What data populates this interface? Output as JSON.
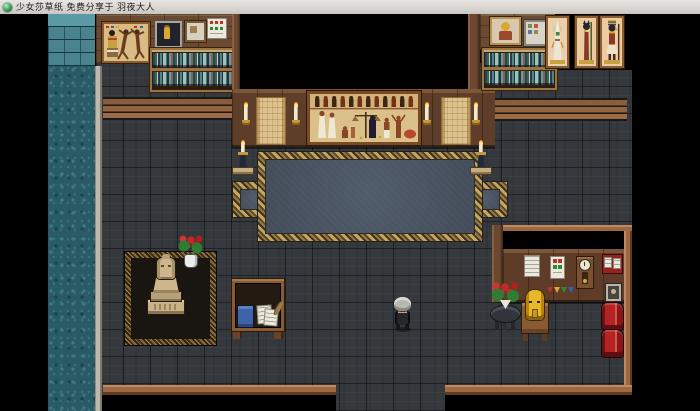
{
  "window": {
    "title": "少女莎草纸 免费分享于 羽夜大人",
    "icon": "rpg-game-icon"
  },
  "scene": {
    "room_label": "Egyptian exhibit study room (RPG map)",
    "objects": [
      "waterfall-column",
      "stone-brick-wall",
      "egyptian-dancers-painting",
      "sarcophagus-picture",
      "small-wall-frame",
      "calendar-frame",
      "bookshelf-left",
      "bookshelf-right",
      "egyptian-mural",
      "gold-relief-panel",
      "wall-candle",
      "deity-painting-osiris",
      "deity-painting-bastet",
      "deity-painting-horus",
      "ornate-carpet",
      "candle-stand",
      "statue-platform",
      "pharaoh-statue",
      "rose-vase",
      "writing-desk",
      "blue-book",
      "papers",
      "quill",
      "player-character",
      "notice-paper",
      "poster",
      "cuckoo-clock",
      "pin-board",
      "photo-frame",
      "party-garland",
      "round-table-roses",
      "gold-mask-table",
      "red-chair",
      "south-doorway"
    ],
    "colors": {
      "floor": "#35393d",
      "water": "#2a5a64",
      "wood_wall": "#5e3e29",
      "carpet_field": "#4c5664",
      "carpet_gold": "#c9a55c",
      "papyrus": "#dcc08a",
      "accent_red": "#b42424",
      "gold": "#d8a830",
      "titlebar_bg": "#d8d5d0"
    }
  }
}
